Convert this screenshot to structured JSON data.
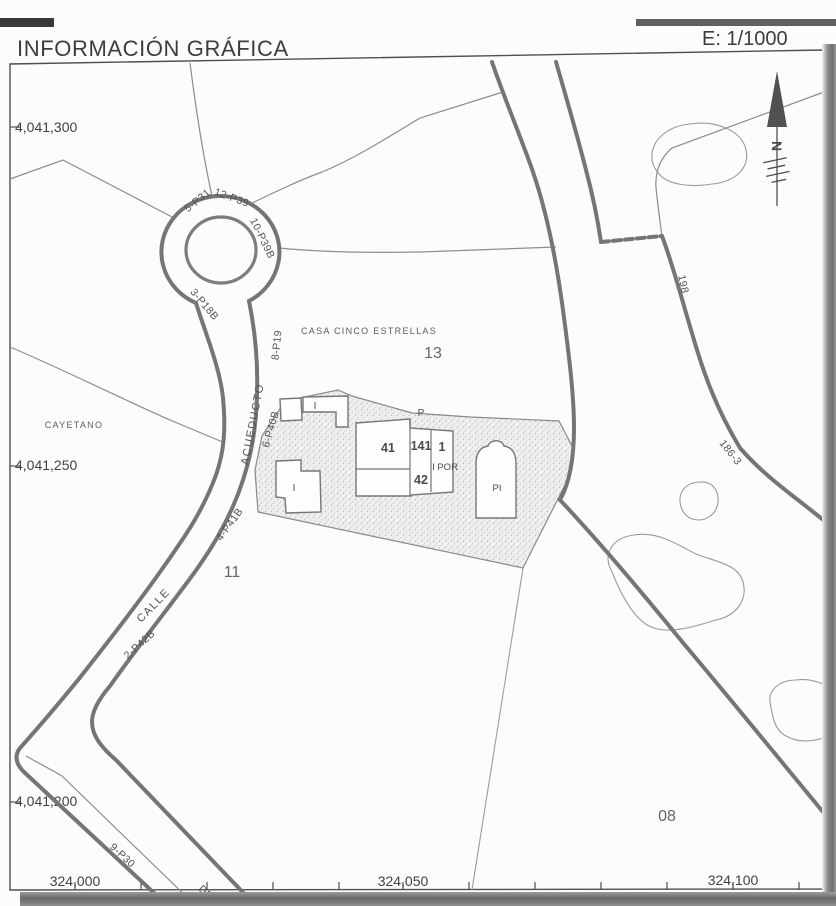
{
  "header": {
    "title": "INFORMACIÓN GRÁFICA",
    "scale": "E: 1/1000"
  },
  "axes": {
    "y": [
      "4,041,300",
      "4,041,250",
      "4,041,200"
    ],
    "x": [
      "324,000",
      "324,050",
      "324,100"
    ]
  },
  "parcels": {
    "casa_cinco_estrellas": "CASA CINCO ESTRELLAS",
    "n13": "13",
    "n11": "11",
    "n08": "08",
    "cayetano": "CAYETANO",
    "n186_3": "186-3",
    "n198": "198"
  },
  "streets": {
    "calle": "CALLE",
    "acueducto": "ACUEDUCTO",
    "codes": [
      "5-P31",
      "12-P39",
      "10-P39B",
      "3-P18B",
      "8-P19",
      "6-P40B",
      "4-P41B",
      "2-P42B",
      "9-P30",
      "DE"
    ]
  },
  "buildings": {
    "p": "P",
    "i_upper": "I",
    "i_lower": "I",
    "n41": "41",
    "n141": "141",
    "n1": "1",
    "por": "I POR",
    "n42": "42",
    "pi": "PI"
  },
  "compass": {
    "north": "N"
  }
}
